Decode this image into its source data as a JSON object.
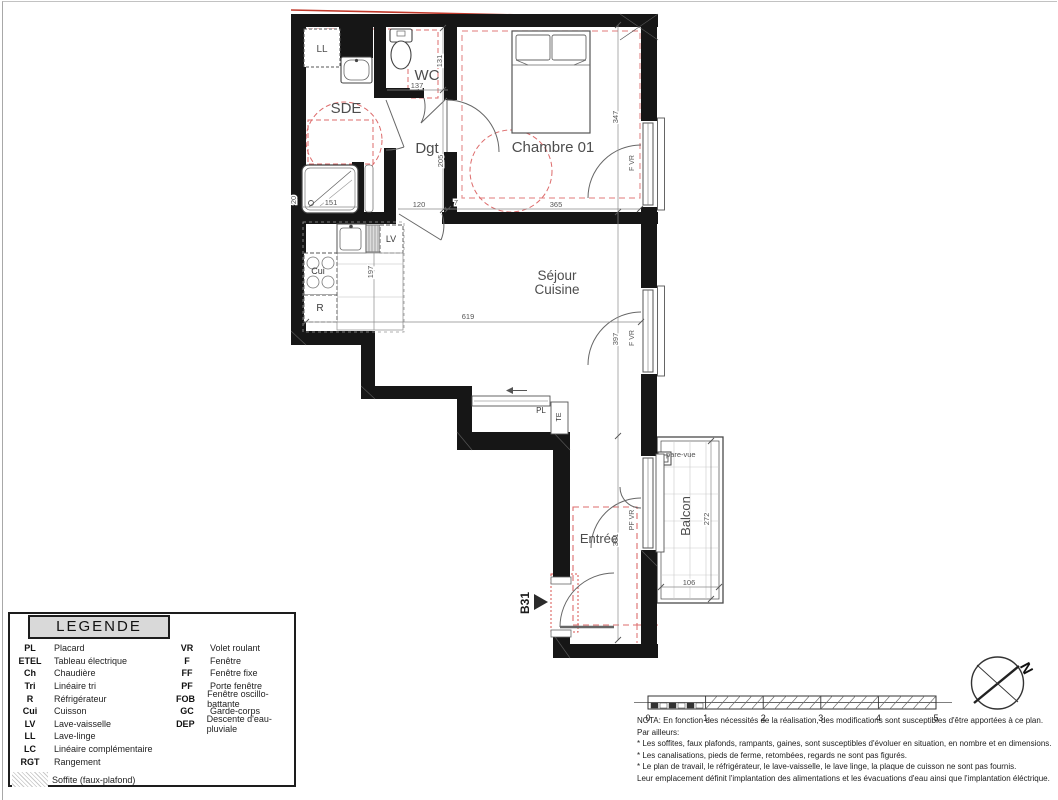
{
  "plan": {
    "unit": "B31",
    "rooms": {
      "ll": "LL",
      "wc": "WC",
      "sde": "SDE",
      "dgt": "Dgt",
      "chambre": "Chambre 01",
      "sejour_line1": "Séjour",
      "sejour_line2": "Cuisine",
      "entree": "Entrée",
      "balcon": "Balcon"
    },
    "fixtures": {
      "lv": "LV",
      "cui": "Cui",
      "r": "R",
      "pl": "PL",
      "te": "TE"
    },
    "openings": {
      "chambre_window": "F VR",
      "sejour_window": "F VR",
      "entree_window": "PF VR"
    },
    "balcony": {
      "pare_vue": "pare-vue"
    },
    "dims": {
      "wc_h": "131",
      "wc_w": "137",
      "dgt_h": "205",
      "dgt_w": "120",
      "dgt_small": "7",
      "shower_w": "151",
      "wall_seg": "20",
      "chambre_h": "347",
      "chambre_w": "365",
      "kitchen_depth": "197",
      "sejour_w": "619",
      "sejour_h": "397",
      "entree_h": "391",
      "balcon_h": "272",
      "balcon_w": "106"
    },
    "colors": {
      "wall": "#161616",
      "red": "#d9534f",
      "pink": "#e79494",
      "accent_gray": "#d9d9d9"
    }
  },
  "legend": {
    "title": "LEGENDE",
    "left": [
      {
        "abbr": "PL",
        "label": "Placard"
      },
      {
        "abbr": "ETEL",
        "label": "Tableau électrique"
      },
      {
        "abbr": "Ch",
        "label": "Chaudière"
      },
      {
        "abbr": "Tri",
        "label": "Linéaire tri"
      },
      {
        "abbr": "R",
        "label": "Réfrigérateur"
      },
      {
        "abbr": "Cui",
        "label": "Cuisson"
      },
      {
        "abbr": "LV",
        "label": "Lave-vaisselle"
      },
      {
        "abbr": "LL",
        "label": "Lave-linge"
      },
      {
        "abbr": "LC",
        "label": "Linéaire complémentaire"
      },
      {
        "abbr": "RGT",
        "label": "Rangement"
      }
    ],
    "right": [
      {
        "abbr": "VR",
        "label": "Volet roulant"
      },
      {
        "abbr": "F",
        "label": "Fenêtre"
      },
      {
        "abbr": "FF",
        "label": "Fenêtre fixe"
      },
      {
        "abbr": "PF",
        "label": "Porte fenêtre"
      },
      {
        "abbr": "FOB",
        "label": "Fenêtre oscillo-battante"
      },
      {
        "abbr": "GC",
        "label": "Garde-corps"
      },
      {
        "abbr": "DEP",
        "label": "Descente d'eau-pluviale"
      }
    ],
    "soffite_label": "Soffite (faux-plafond)"
  },
  "scale_bar": {
    "ticks": [
      "0",
      "1",
      "2",
      "3",
      "4",
      "5"
    ]
  },
  "compass": {
    "north": "N"
  },
  "nota": {
    "lines": [
      "NOTA: En fonction des nécessités de la réalisation, des modifications sont susceptibles d'être apportées à ce plan.",
      "Par ailleurs:",
      "* Les soffites, faux plafonds, rampants, gaines, sont susceptibles d'évoluer en situation, en nombre et en dimensions.",
      "* Les canalisations, pieds de ferme, retombées, regards ne sont pas figurés.",
      "* Le plan de travail, le réfrigérateur, le lave-vaisselle, le lave linge, la plaque de cuisson ne sont pas fournis.",
      "Leur emplacement définit l'implantation des alimentations et les évacuations d'eau ainsi que l'implantation éléctrique."
    ]
  }
}
